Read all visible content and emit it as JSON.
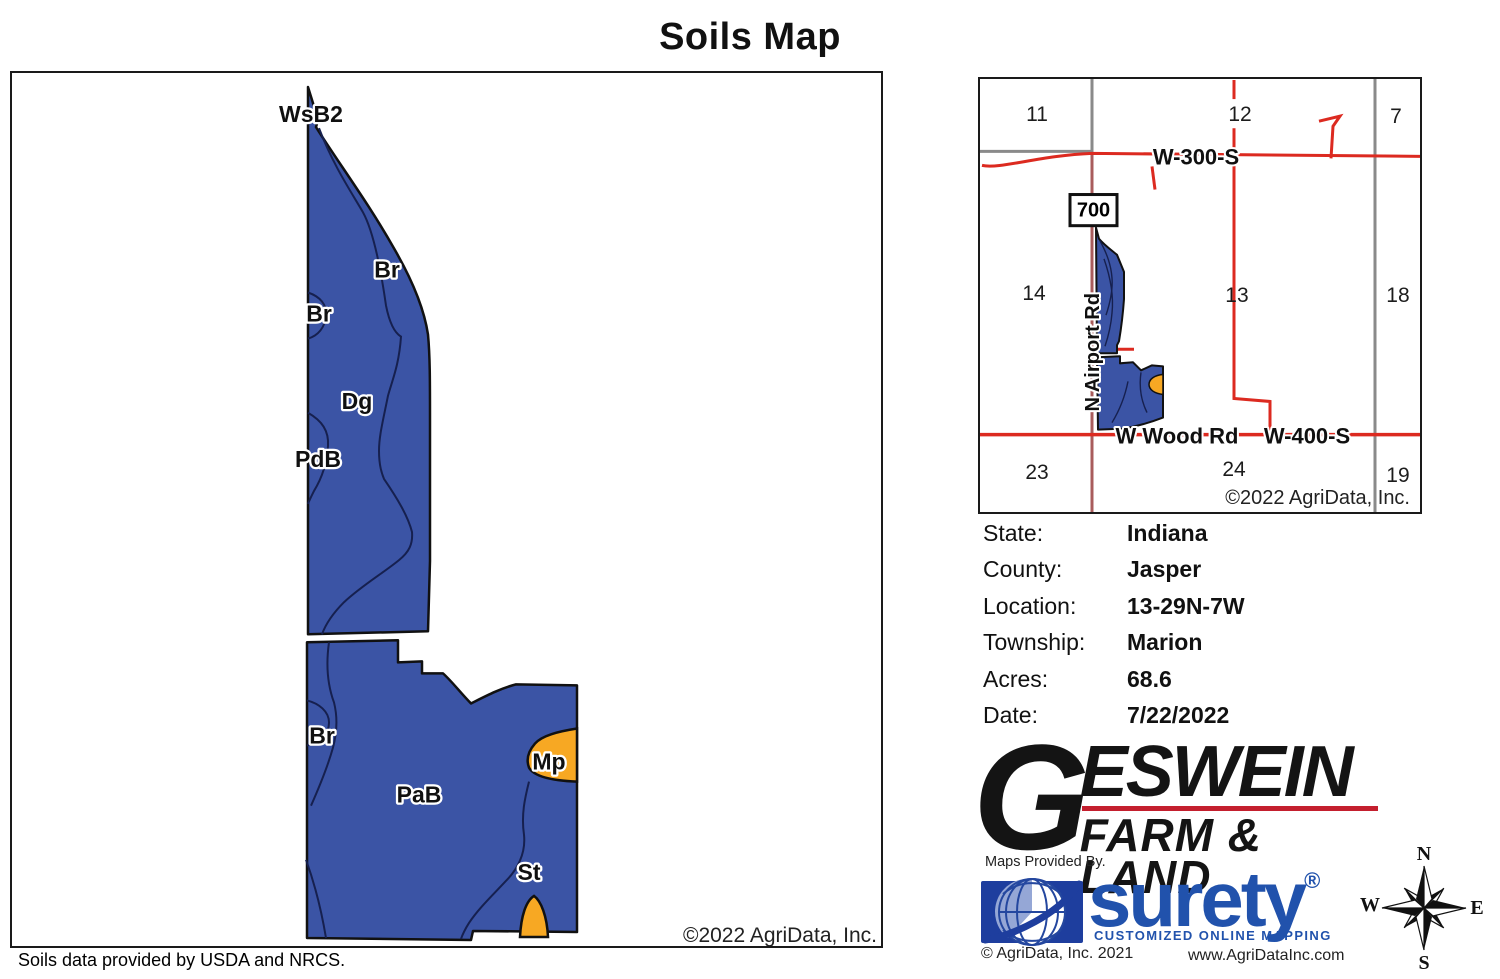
{
  "title": "Soils Map",
  "footnote": "Soils data provided by USDA and NRCS.",
  "colors": {
    "soil_blue": "#3b54a5",
    "soil_orange": "#f7a823",
    "outline_black": "#111111",
    "contour_navy": "#16204f",
    "road_red": "#dc2a20",
    "road_maroon": "#a95c5c",
    "road_gray": "#8a8a8a",
    "surety_blue": "#2152ac",
    "geswein_red": "#c41f2e"
  },
  "soils_map": {
    "labels": [
      "WsB2",
      "Br",
      "Br",
      "Dg",
      "PdB",
      "Br",
      "PaB",
      "Mp",
      "St"
    ],
    "copyright": "©2022 AgriData, Inc."
  },
  "location_map": {
    "sections": [
      "11",
      "12",
      "7",
      "14",
      "13",
      "18",
      "23",
      "24",
      "19"
    ],
    "roads": {
      "w300s": "W-300-S",
      "wwood": "W Wood Rd",
      "w400s": "W-400-S",
      "airport": "N Airport Rd",
      "badge": "700"
    },
    "copyright": "©2022 AgriData, Inc."
  },
  "info": {
    "rows": [
      {
        "label": "State:",
        "value": "Indiana"
      },
      {
        "label": "County:",
        "value": "Jasper"
      },
      {
        "label": "Location:",
        "value": "13-29N-7W"
      },
      {
        "label": "Township:",
        "value": "Marion"
      },
      {
        "label": "Acres:",
        "value": "68.6"
      },
      {
        "label": "Date:",
        "value": "7/22/2022"
      }
    ]
  },
  "branding": {
    "geswein_g": "G",
    "geswein_rest": "ESWEIN",
    "geswein_sub": "FARM & LAND",
    "provided_by": "Maps Provided By.",
    "surety": "surety",
    "registered": "®",
    "surety_tag": "CUSTOMIZED ONLINE MAPPING",
    "agridata_2021": "© AgriData, Inc. 2021",
    "website": "www.AgriDataInc.com"
  },
  "compass": {
    "n": "N",
    "s": "S",
    "e": "E",
    "w": "W"
  }
}
